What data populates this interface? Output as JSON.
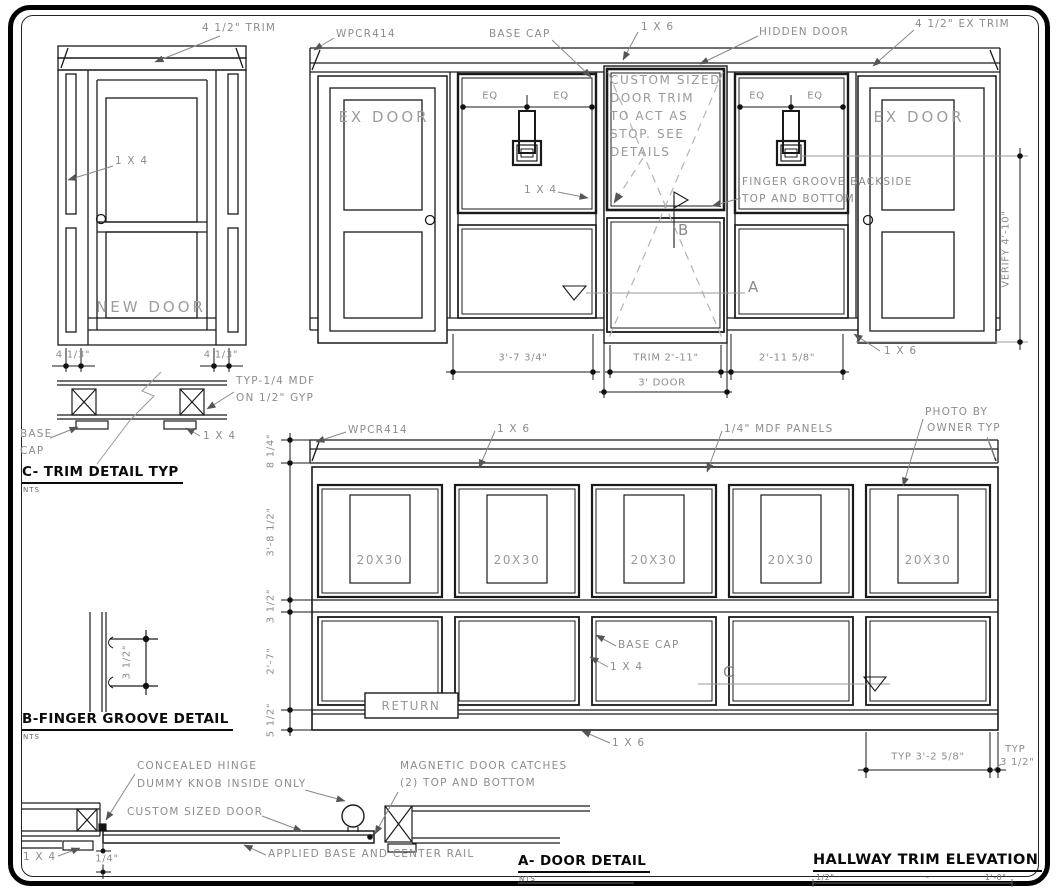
{
  "new_door_elevation": {
    "trim_label": "4 1/2\" TRIM",
    "stile_label": "1 X 4",
    "door_name": "NEW DOOR",
    "dim_left": "4 1/3\"",
    "dim_right": "4 1/3\""
  },
  "upper_elevation": {
    "crown_label": "WPCR414",
    "base_cap_label": "BASE CAP",
    "board_label": "1 X 6",
    "hidden_door_label": "HIDDEN DOOR",
    "ex_trim_label": "4 1/2\" EX TRIM",
    "ex_door_left": "EX DOOR",
    "ex_door_right": "EX DOOR",
    "eq": "EQ",
    "panel_board_label": "1 X 4",
    "note_lines": [
      "CUSTOM SIZED",
      "DOOR TRIM",
      "TO ACT AS",
      "STOP. SEE",
      "DETAILS"
    ],
    "finger_note_1": "FINGER GROOVE BACKSIDE",
    "finger_note_2": "TOP AND BOTTOM",
    "marker_a": "A",
    "marker_b": "B",
    "dim_panel_left": "3'-7 3/4\"",
    "dim_trim": "TRIM 2'-11\"",
    "dim_door": "3' DOOR",
    "dim_panel_right": "2'-11 5/8\"",
    "dim_verify": "VERIFY 4'-10\"",
    "base_board_label": "1 X 6"
  },
  "trim_detail": {
    "title": "C- TRIM DETAIL TYP",
    "scale": "NTS",
    "mdf_note_1": "TYP-1/4 MDF",
    "mdf_note_2": "ON 1/2\" GYP",
    "base_cap_1": "BASE",
    "base_cap_2": "CAP",
    "board_label": "1 X 4"
  },
  "lower_elevation": {
    "crown_label": "WPCR414",
    "board_label": "1 X 6",
    "mdf_label": "1/4\" MDF PANELS",
    "photo_note_1": "PHOTO BY",
    "photo_note_2": "OWNER TYP",
    "photos": [
      "20X30",
      "20X30",
      "20X30",
      "20X30",
      "20X30"
    ],
    "dims_left": [
      "8 1/4\"",
      "3'-8 1/2\"",
      "3 1/2\"",
      "2'-7\"",
      "5 1/2\""
    ],
    "base_cap_label": "BASE CAP",
    "stile_label": "1 X 4",
    "return_label": "RETURN",
    "marker_c": "C",
    "base_board_label": "1 X 6",
    "dim_typ_panel": "TYP 3'-2 5/8\"",
    "dim_typ_stile_1": "TYP",
    "dim_typ_stile_2": "3 1/2\""
  },
  "finger_groove_detail": {
    "title": "B-FINGER GROOVE DETAIL",
    "scale": "NTS",
    "dim": "3 1/2\""
  },
  "door_detail": {
    "title": "A- DOOR DETAIL",
    "scale": "NTS",
    "hinge_label": "CONCEALED HINGE",
    "knob_label": "DUMMY KNOB INSIDE ONLY",
    "custom_label": "CUSTOM SIZED DOOR",
    "catches_1": "MAGNETIC DOOR CATCHES",
    "catches_2": "(2) TOP AND BOTTOM",
    "applied_label": "APPLIED BASE AND CENTER RAIL",
    "board_label": "1 X 4",
    "gap_dim": "1/4\""
  },
  "hallway_title": {
    "title": "HALLWAY TRIM ELEVATION",
    "scale_left": "1/2\"",
    "scale_dash": "-",
    "scale_right": "1'-0\""
  }
}
